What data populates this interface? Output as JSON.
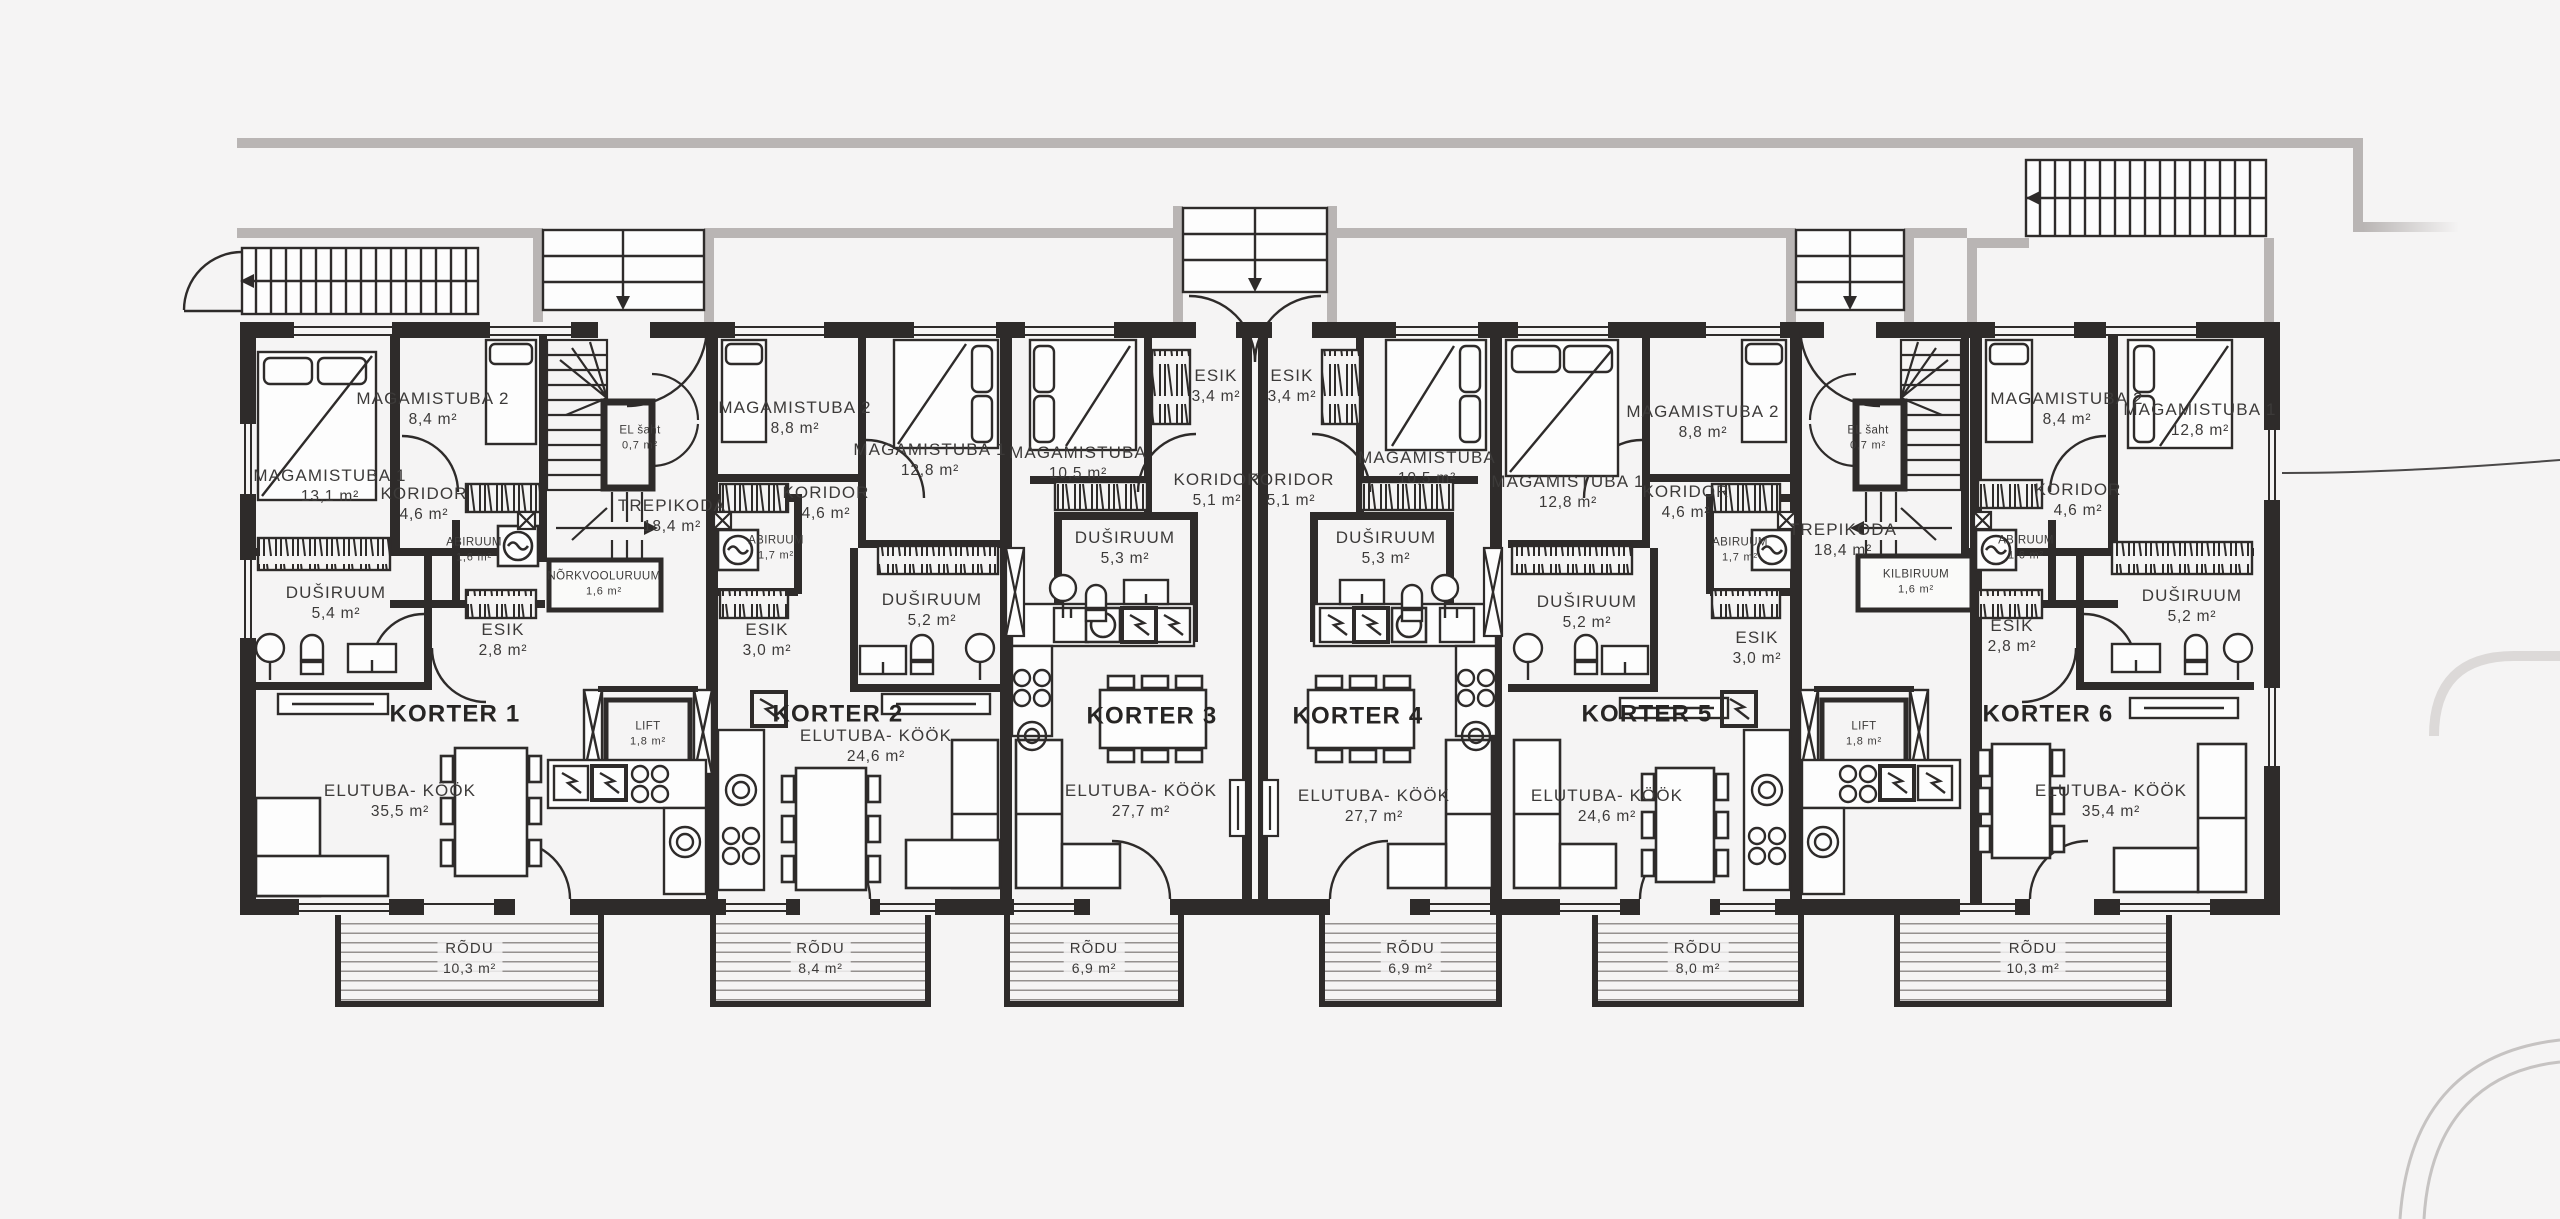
{
  "colors": {
    "background": "#f5f4f4",
    "walls": "#2e2b2a",
    "exterior_gray": "#b9b5b4",
    "text": "#3c3a39"
  },
  "units": [
    {
      "title": "KORTER 1",
      "rooms": [
        {
          "name": "MAGAMISTUBA 1",
          "area": "13,1 m²"
        },
        {
          "name": "MAGAMISTUBA 2",
          "area": "8,4 m²"
        },
        {
          "name": "KORIDOR",
          "area": "4,6 m²"
        },
        {
          "name": "ABIRUUM",
          "area": "1,6 m²"
        },
        {
          "name": "DUŠIRUUM",
          "area": "5,4 m²"
        },
        {
          "name": "ESIK",
          "area": "2,8 m²"
        },
        {
          "name": "ELUTUBA- KÖÖK",
          "area": "35,5 m²"
        }
      ],
      "balcony": {
        "name": "RÕDU",
        "area": "10,3 m²"
      }
    },
    {
      "title": "KORTER 2",
      "rooms": [
        {
          "name": "MAGAMISTUBA 2",
          "area": "8,8 m²"
        },
        {
          "name": "MAGAMISTUBA 1",
          "area": "12,8 m²"
        },
        {
          "name": "KORIDOR",
          "area": "4,6 m²"
        },
        {
          "name": "ABIRUUM",
          "area": "1,7 m²"
        },
        {
          "name": "ESIK",
          "area": "3,0 m²"
        },
        {
          "name": "DUŠIRUUM",
          "area": "5,2 m²"
        },
        {
          "name": "ELUTUBA- KÖÖK",
          "area": "24,6 m²"
        }
      ],
      "balcony": {
        "name": "RÕDU",
        "area": "8,4 m²"
      }
    },
    {
      "title": "KORTER 3",
      "rooms": [
        {
          "name": "ESIK",
          "area": "3,4 m²"
        },
        {
          "name": "KORIDOR",
          "area": "5,1 m²"
        },
        {
          "name": "MAGAMISTUBA",
          "area": "10,5 m²"
        },
        {
          "name": "DUŠIRUUM",
          "area": "5,3 m²"
        },
        {
          "name": "ELUTUBA- KÖÖK",
          "area": "27,7 m²"
        }
      ],
      "balcony": {
        "name": "RÕDU",
        "area": "6,9 m²"
      }
    },
    {
      "title": "KORTER 4",
      "rooms": [
        {
          "name": "ESIK",
          "area": "3,4 m²"
        },
        {
          "name": "KORIDOR",
          "area": "5,1 m²"
        },
        {
          "name": "MAGAMISTUBA",
          "area": "10,5 m²"
        },
        {
          "name": "DUŠIRUUM",
          "area": "5,3 m²"
        },
        {
          "name": "ELUTUBA- KÖÖK",
          "area": "27,7 m²"
        }
      ],
      "balcony": {
        "name": "RÕDU",
        "area": "6,9 m²"
      }
    },
    {
      "title": "KORTER 5",
      "rooms": [
        {
          "name": "MAGAMISTUBA 1",
          "area": "12,8 m²"
        },
        {
          "name": "MAGAMISTUBA 2",
          "area": "8,8 m²"
        },
        {
          "name": "KORIDOR",
          "area": "4,6 m²"
        },
        {
          "name": "ABIRUUM",
          "area": "1,7 m²"
        },
        {
          "name": "DUŠIRUUM",
          "area": "5,2 m²"
        },
        {
          "name": "ESIK",
          "area": "3,0 m²"
        },
        {
          "name": "ELUTUBA- KÖÖK",
          "area": "24,6 m²"
        }
      ],
      "balcony": {
        "name": "RÕDU",
        "area": "8,0 m²"
      }
    },
    {
      "title": "KORTER 6",
      "rooms": [
        {
          "name": "MAGAMISTUBA 2",
          "area": "8,4 m²"
        },
        {
          "name": "MAGAMISTUBA 1",
          "area": "12,8 m²"
        },
        {
          "name": "KORIDOR",
          "area": "4,6 m²"
        },
        {
          "name": "ABIRUUM",
          "area": "1,6 m²"
        },
        {
          "name": "ESIK",
          "area": "2,8 m²"
        },
        {
          "name": "DUŠIRUUM",
          "area": "5,2 m²"
        },
        {
          "name": "ELUTUBA- KÖÖK",
          "area": "35,4 m²"
        }
      ],
      "balcony": {
        "name": "RÕDU",
        "area": "10,3 m²"
      }
    }
  ],
  "cores": [
    {
      "stairwell": {
        "name": "TREPIKODA",
        "area": "18,4 m²"
      },
      "shaft": {
        "name": "EL šaht",
        "area": "0,7 m²"
      },
      "utility": {
        "name": "NÕRKVOOLURUUM",
        "area": "1,6 m²"
      },
      "lift": {
        "name": "LIFT",
        "area": "1,8 m²"
      }
    },
    {
      "stairwell": {
        "name": "TREPIKODA",
        "area": "18,4 m²"
      },
      "shaft": {
        "name": "EL šaht",
        "area": "0,7 m²"
      },
      "utility": {
        "name": "KILBIRUUM",
        "area": "1,6 m²"
      },
      "lift": {
        "name": "LIFT",
        "area": "1,8 m²"
      }
    }
  ]
}
